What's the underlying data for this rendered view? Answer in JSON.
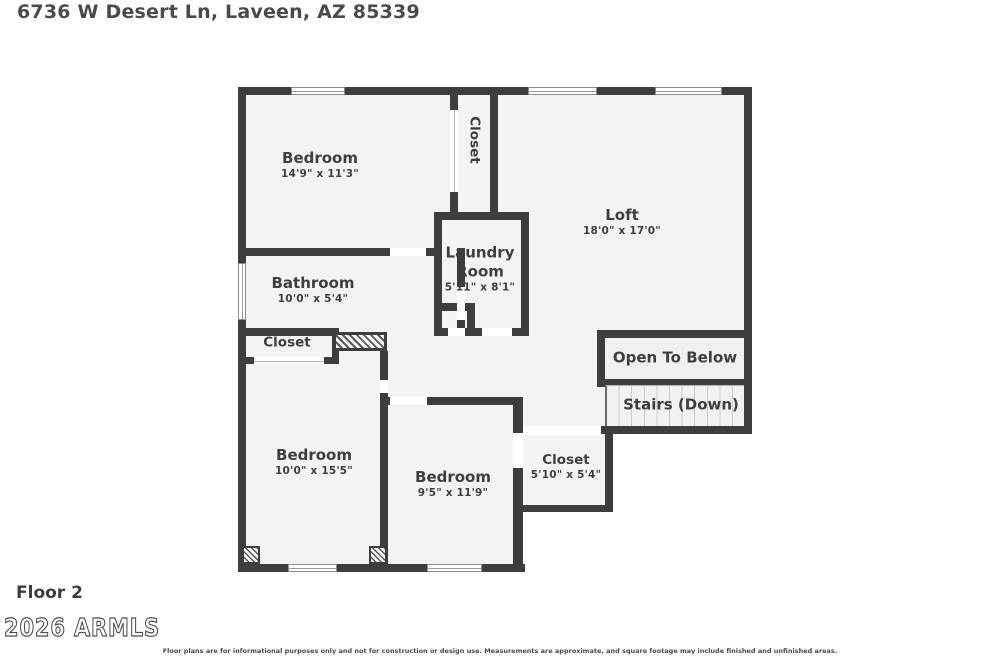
{
  "header": {
    "address": "6736 W Desert Ln, Laveen, AZ 85339"
  },
  "floorplan": {
    "rooms": [
      {
        "name": "Bedroom",
        "dims": "14'9\" x 11'3\""
      },
      {
        "name": "Closet",
        "dims": ""
      },
      {
        "name": "Loft",
        "dims": "18'0\" x 17'0\""
      },
      {
        "name": "Laundry Room",
        "dims": "5'11\" x 8'1\""
      },
      {
        "name": "Bathroom",
        "dims": "10'0\" x 5'4\""
      },
      {
        "name": "Closet",
        "dims": ""
      },
      {
        "name": "Open To Below",
        "dims": ""
      },
      {
        "name": "Stairs (Down)",
        "dims": ""
      },
      {
        "name": "Bedroom",
        "dims": "10'0\" x 15'5\""
      },
      {
        "name": "Bedroom",
        "dims": "9'5\" x 11'9\""
      },
      {
        "name": "Closet",
        "dims": "5'10\" x 5'4\""
      }
    ],
    "colors": {
      "wall": "#3d3d3d",
      "room_fill": "#f3f3f3",
      "text": "#3e3e3e"
    }
  },
  "footer": {
    "floor_label": "Floor 2",
    "watermark": "2026 ARMLS",
    "disclaimer": "Floor plans are for informational purposes only and not for construction or design use. Measurements are approximate, and square footage may include finished and unfinished areas."
  }
}
